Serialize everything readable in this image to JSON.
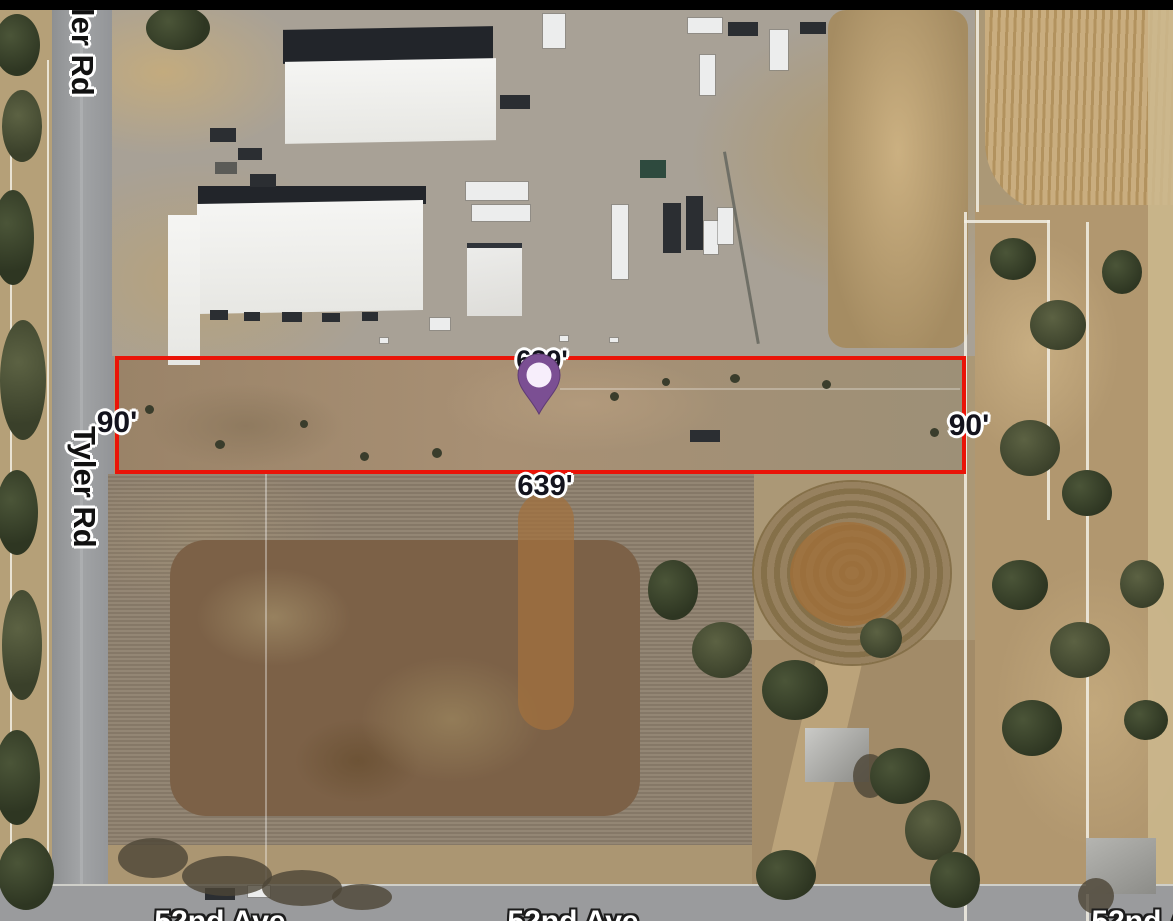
{
  "colors": {
    "parcel_outline": "#ea1408",
    "pin_fill": "#7b4f93",
    "pin_center": "#f7eefb",
    "dimension_label_color": "#13131d",
    "road_label_color": "#ffffff"
  },
  "parcel": {
    "top_length_label": "639'",
    "bottom_length_label": "639'",
    "left_width_label": "90'",
    "right_width_label": "90'"
  },
  "roads": {
    "tyler_top_label": "ler Rd",
    "tyler_label": "Tyler Rd",
    "avenue_label_left": "52nd Ave",
    "avenue_label_center": "52nd Ave",
    "avenue_label_right": "52nd Ave"
  },
  "icons": {
    "marker": "location-pin-icon"
  }
}
